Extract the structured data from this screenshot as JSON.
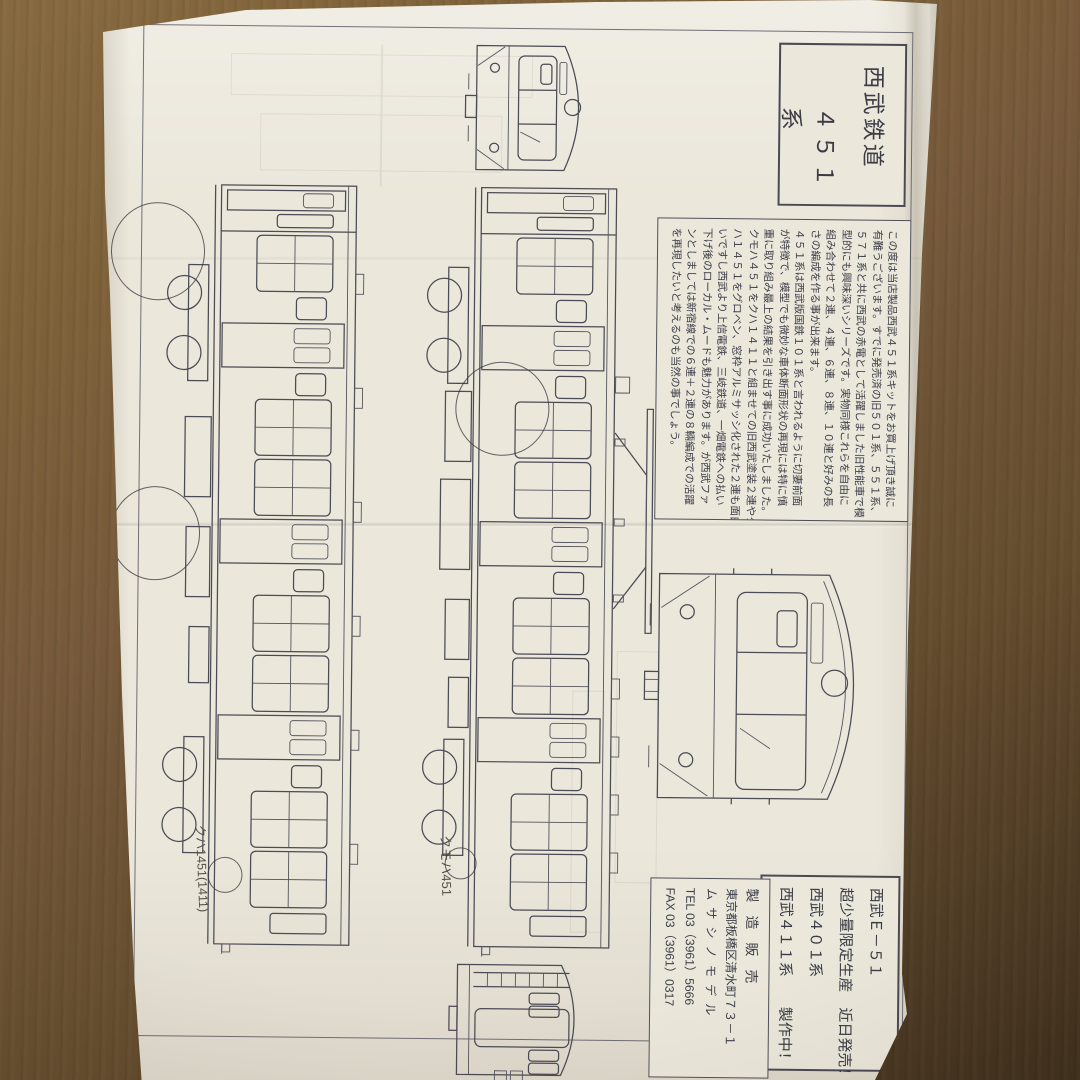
{
  "colors": {
    "paper": "#ebe7db",
    "ink": "#4b4b55",
    "wood": "#75593a",
    "pencil": "#565248"
  },
  "title_box": {
    "line1": "西武鉄道",
    "line2": "４５１系"
  },
  "intro_box": {
    "lines": [
      "この度は当店製品西武４５１系キットをお買上げ頂き誠に",
      "有難うございます。すでに発売済の旧５０１系、５５１系、",
      "５７１系と共に西武の赤電として活躍しました旧性能車で模",
      "型的にも興味深いシリーズです。実物同様これらを自由に",
      "組み合わせて２連、４連、６連、８連、１０連と好みの長",
      "さの編成を作る事が出来ます。",
      "４５１系は西武版国鉄１０１系と言われるように切妻前面",
      "が特徴で、模型でも微妙な車体断面形状の再現には特に慎",
      "重に取り組み最上の結果を引き出す事に成功いたしました。",
      "クモハ４５１をクハ１４１１と組ませての旧西武塗装２連やク",
      "ハ１４５１をグロベン、窓枠アルミサッシ化された２連も面白",
      "いですし西武より上信電鉄、三岐鉄道、一畑電鉄への払い",
      "下げ後のローカル・ムードも魅力があります。が西武ファ",
      "ンとしましては新宿線での６連＋２連の８輛編成での活躍",
      "を再現したいと考えるのも当然の事でしょう。"
    ]
  },
  "announce_box": {
    "lines": [
      "西武Ｅ－５１",
      "超少量限定生産　近日発売！",
      "西武４０１系",
      "西武４１１系　　製作中！"
    ]
  },
  "maker_box": {
    "role": "製造販売",
    "address": "東京都板橋区清水町７３－１",
    "name": "ムサシノモデル",
    "tel": "TEL 03（3961）5666",
    "fax": "FAX 03（3961）0317"
  },
  "drawing_labels": {
    "motor_car": "クモハ451",
    "trailer_car": "クハ1451(1411)"
  }
}
